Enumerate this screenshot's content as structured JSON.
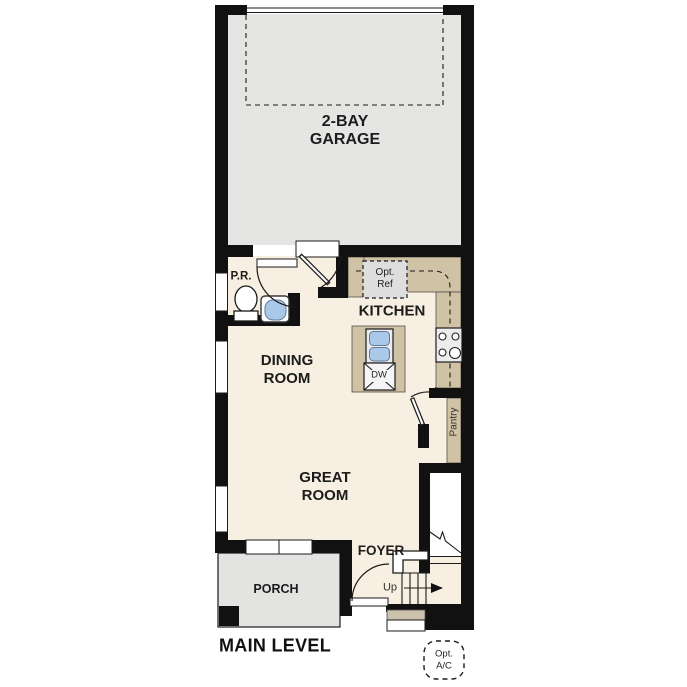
{
  "title": "MAIN LEVEL",
  "colors": {
    "wall": "#111111",
    "floor": "#f7efe1",
    "garage": "#e5e5e3",
    "porch": "#e3e3e1",
    "counter": "#cfc2a5",
    "appliance": "#ececec",
    "sink_blue": "#aac9e8",
    "ref_gray": "#dedede",
    "step_tan": "#cdc3ad"
  },
  "rooms": {
    "garage": {
      "lines": [
        "2-BAY",
        "GARAGE"
      ]
    },
    "powder_room": {
      "label": "P.R."
    },
    "kitchen": {
      "label": "KITCHEN"
    },
    "dining_room": {
      "lines": [
        "DINING",
        "ROOM"
      ]
    },
    "great_room": {
      "lines": [
        "GREAT",
        "ROOM"
      ]
    },
    "pantry": {
      "label": "Pantry"
    },
    "foyer": {
      "label": "FOYER"
    },
    "porch": {
      "label": "PORCH"
    }
  },
  "annotations": {
    "stairs_up": "Up",
    "dishwasher": "DW",
    "optional_refrigerator": {
      "lines": [
        "Opt.",
        "Ref"
      ]
    },
    "optional_ac": {
      "lines": [
        "Opt.",
        "A/C"
      ]
    }
  }
}
